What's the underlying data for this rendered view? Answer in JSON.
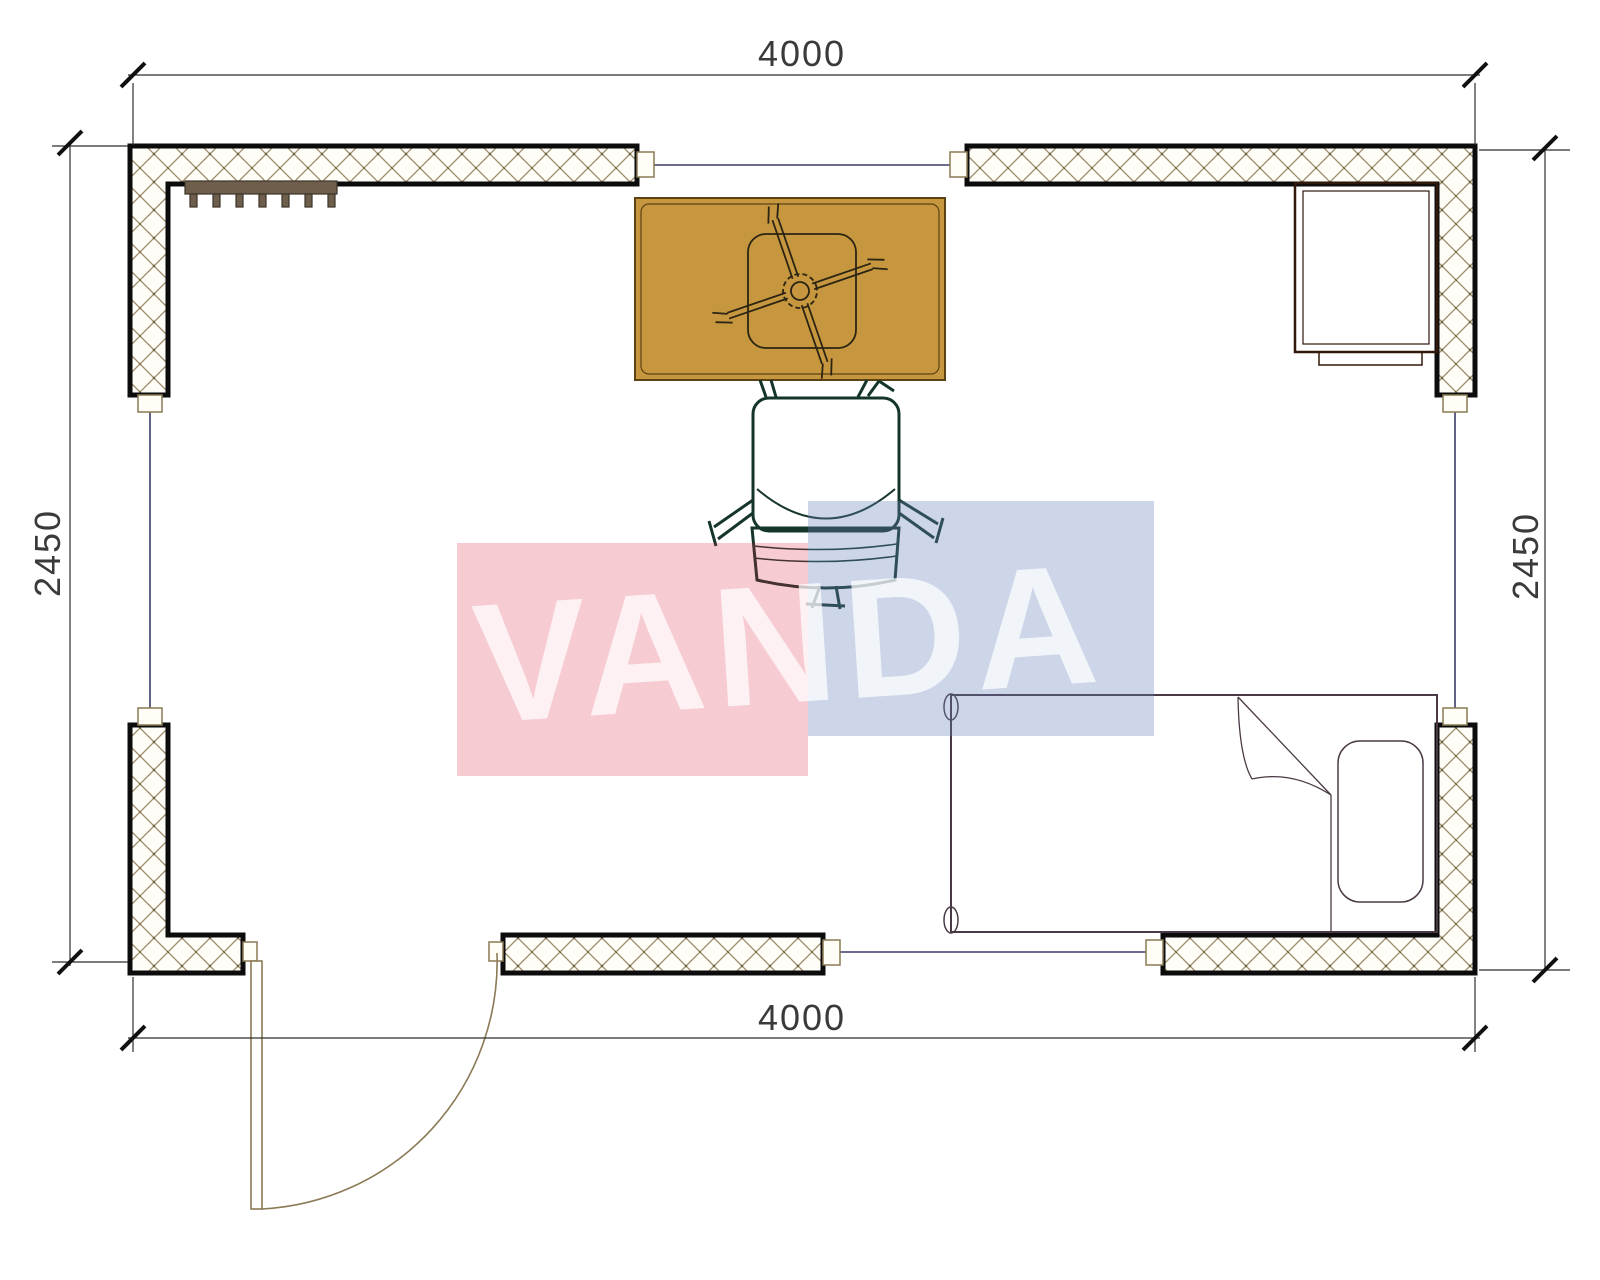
{
  "plan": {
    "dimensions": {
      "top": "4000",
      "bottom": "4000",
      "left": "2450",
      "right": "2450"
    },
    "watermark": {
      "text": "VANDA",
      "pink_block_color": "#d82844",
      "blue_block_color": "#6584b8"
    },
    "colors": {
      "wall_fill": "#fefdf8",
      "wall_hatch": "#9a8a68",
      "wall_border": "#0c0c0c",
      "window_line": "#3b3b6b",
      "door_line": "#8a7a55",
      "dimension_line": "#2f2f2f",
      "table": "#c6973f",
      "chair": "#4f9f80",
      "bed": "#9c8494",
      "desk": "#8a4a2a",
      "radiator": "#6d5f4c"
    }
  }
}
